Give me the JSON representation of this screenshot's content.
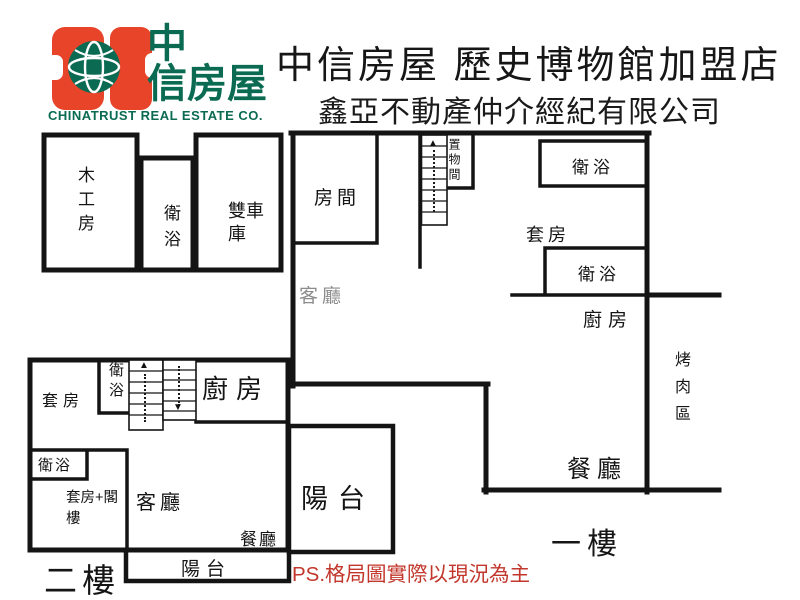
{
  "header": {
    "logo": {
      "name_line1": "中",
      "name_line2": "信房屋",
      "english": "CHINATRUST REAL ESTATE CO.",
      "brand_orange": "#E8442A",
      "brand_green": "#0A6B52"
    },
    "title": "中信房屋 歷史博物館加盟店",
    "subtitle": "鑫亞不動產仲介經紀有限公司"
  },
  "plans": {
    "garage": {
      "rooms": {
        "woodwork": "木工房",
        "bath": "衛浴",
        "double_garage": "雙車庫"
      }
    },
    "floor1": {
      "label": "一樓",
      "rooms": {
        "bedroom": "房間",
        "storage": "置物間",
        "bath_top": "衛浴",
        "suite": "套房",
        "bath_mid": "衛浴",
        "kitchen": "廚房",
        "living": "客廳",
        "dining": "餐廳",
        "bbq": "烤肉區"
      }
    },
    "floor2": {
      "label": "二樓",
      "rooms": {
        "suite": "套房",
        "bath_top": "衛浴",
        "kitchen": "廚房",
        "bath_mid": "衛浴",
        "suite_loft": "套房+閣樓",
        "living": "客廳",
        "dining": "餐廳",
        "balcony_strip": "陽台",
        "balcony_square": "陽台"
      }
    }
  },
  "icons": {
    "stairs_up_arrow": "▲",
    "stairs_down_arrow": "▼"
  },
  "footer": {
    "note": "PS.格局圖實際以現況為主",
    "note_color": "#C2362B"
  },
  "colors": {
    "wall": "#141414",
    "faint_label": "#8C8C8C",
    "background": "#FFFFFF"
  }
}
